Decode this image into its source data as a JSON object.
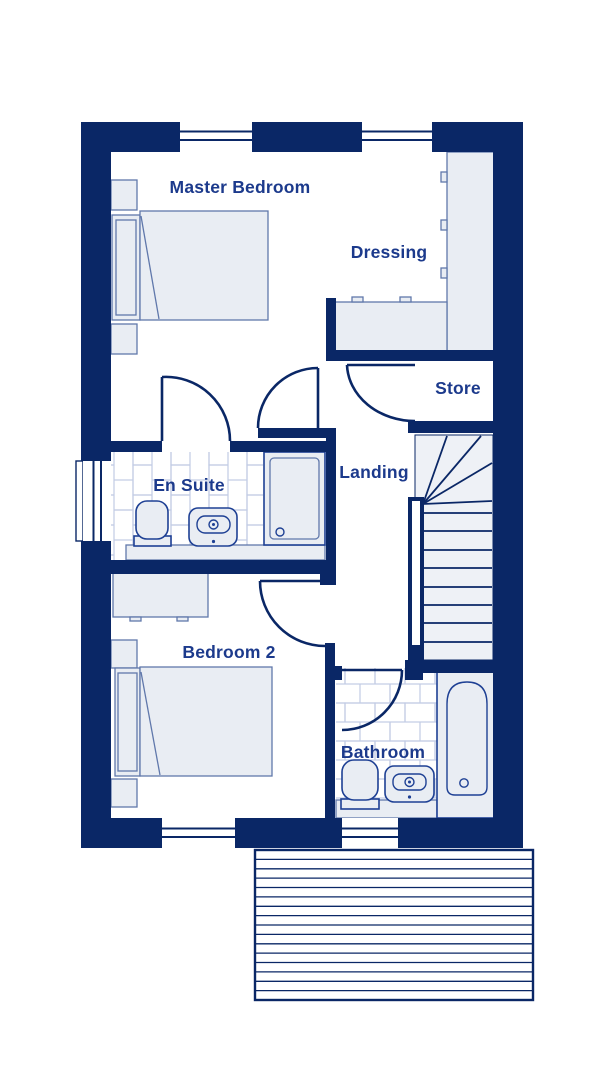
{
  "plan": {
    "rooms": [
      {
        "id": "master-bedroom",
        "label": "Master Bedroom",
        "fixtures": [
          "double-bed",
          "bedside-table",
          "bedside-table"
        ]
      },
      {
        "id": "dressing",
        "label": "Dressing",
        "fixtures": [
          "wardrobe",
          "counter-unit"
        ]
      },
      {
        "id": "store",
        "label": "Store",
        "fixtures": []
      },
      {
        "id": "landing",
        "label": "Landing",
        "fixtures": [
          "staircase"
        ]
      },
      {
        "id": "en-suite",
        "label": "En Suite",
        "fixtures": [
          "toilet",
          "basin",
          "shower",
          "vanity-ledge"
        ]
      },
      {
        "id": "bedroom-2",
        "label": "Bedroom 2",
        "fixtures": [
          "double-bed",
          "desk",
          "bedside-table",
          "bedside-table"
        ]
      },
      {
        "id": "bathroom",
        "label": "Bathroom",
        "fixtures": [
          "toilet",
          "basin",
          "bath"
        ]
      }
    ],
    "stairs": {
      "straight_treads": 8,
      "winder_treads": 5
    },
    "canopy_slats": 16,
    "window_count": 5,
    "door_count": 5,
    "colors": {
      "wall": "#0a2766",
      "fixture_line": "#1e4094",
      "furniture_line": "#6078ab",
      "tile_line": "#c2cce4",
      "fixture_fill": "#e9edf3",
      "stair_fill": "#eef1f6",
      "label_text": "#1c3a8c",
      "background": "#ffffff"
    }
  }
}
